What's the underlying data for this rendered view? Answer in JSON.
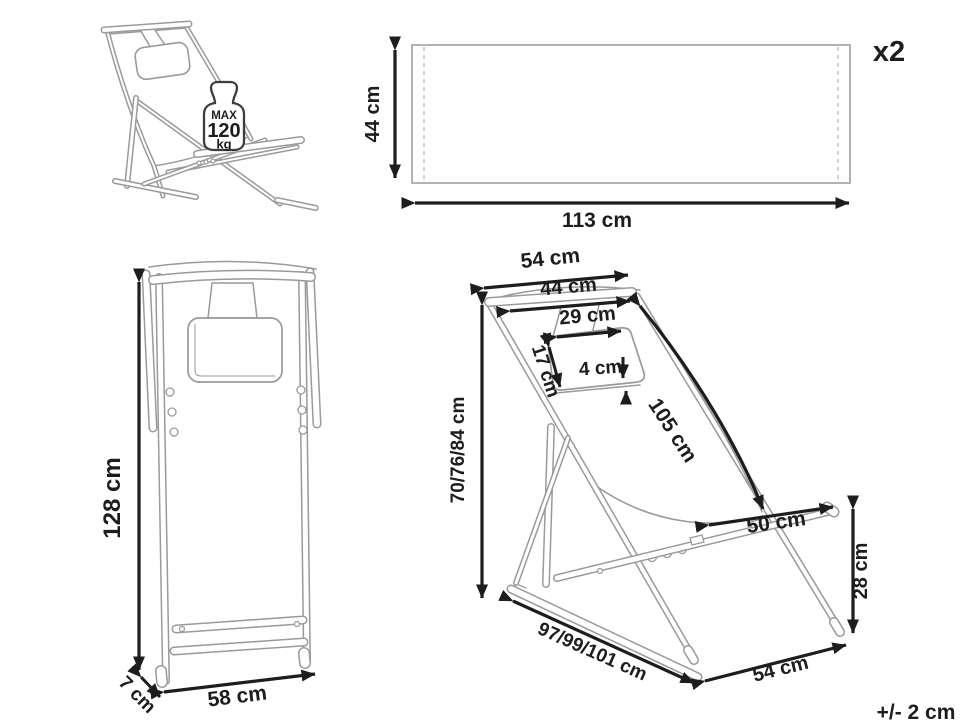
{
  "views": {
    "perspective": {
      "max_label": "MAX",
      "max_weight": "120",
      "weight_unit": "kg"
    },
    "fabric_panel": {
      "height": "44 cm",
      "width": "113 cm",
      "quantity": "x2"
    },
    "front": {
      "height": "128 cm",
      "width": "58 cm",
      "depth": "7 cm"
    },
    "side": {
      "top_width": "54 cm",
      "frame_width": "44 cm",
      "pillow_width": "29 cm",
      "pillow_height": "17 cm",
      "pillow_thickness": "4 cm",
      "fabric_length": "105 cm",
      "back_height": "70/76/84 cm",
      "seat_length": "50 cm",
      "seat_front_height": "28 cm",
      "base_depth": "97/99/101 cm",
      "base_width": "54 cm"
    },
    "tolerance": "+/- 2 cm"
  },
  "colors": {
    "line_art": "#9a9a9a",
    "dimension": "#1d1d1d",
    "background": "#ffffff"
  }
}
